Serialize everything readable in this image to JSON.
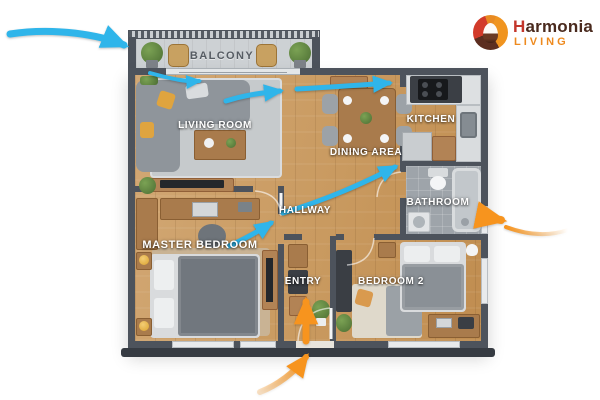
{
  "brand": {
    "name_first": "H",
    "name_rest": "armonia",
    "tagline": "LIVING",
    "colors": {
      "name": "#4A2A1E",
      "name_accent": "#C3362B",
      "tagline": "#EE8A1E",
      "logo_red": "#D23B2A",
      "logo_orange": "#F0941F",
      "logo_brown": "#5C2E20"
    }
  },
  "floorplan": {
    "rooms": [
      {
        "id": "balcony",
        "label": "BALCONY"
      },
      {
        "id": "living-room",
        "label": "LIVING ROOM"
      },
      {
        "id": "dining-area",
        "label": "DINING AREA"
      },
      {
        "id": "kitchen",
        "label": "KITCHEN"
      },
      {
        "id": "hallway",
        "label": "HALLWAY"
      },
      {
        "id": "bathroom",
        "label": "BATHROOM"
      },
      {
        "id": "master-bedroom",
        "label": "MASTER BEDROOM"
      },
      {
        "id": "entry",
        "label": "ENTRY"
      },
      {
        "id": "bedroom-2",
        "label": "BEDROOM 2"
      }
    ],
    "airflow_arrows": {
      "blue_color": "#2FB5EA",
      "orange_color": "#F7941E",
      "blue_count": 6,
      "orange_count": 3
    },
    "palette": {
      "wall": "#4D535C",
      "wood_floor": "#C99F6A",
      "balcony_floor": "#CDD1D4",
      "bathroom_floor": "#9EA4AA",
      "rug": "#C6CACC"
    }
  }
}
